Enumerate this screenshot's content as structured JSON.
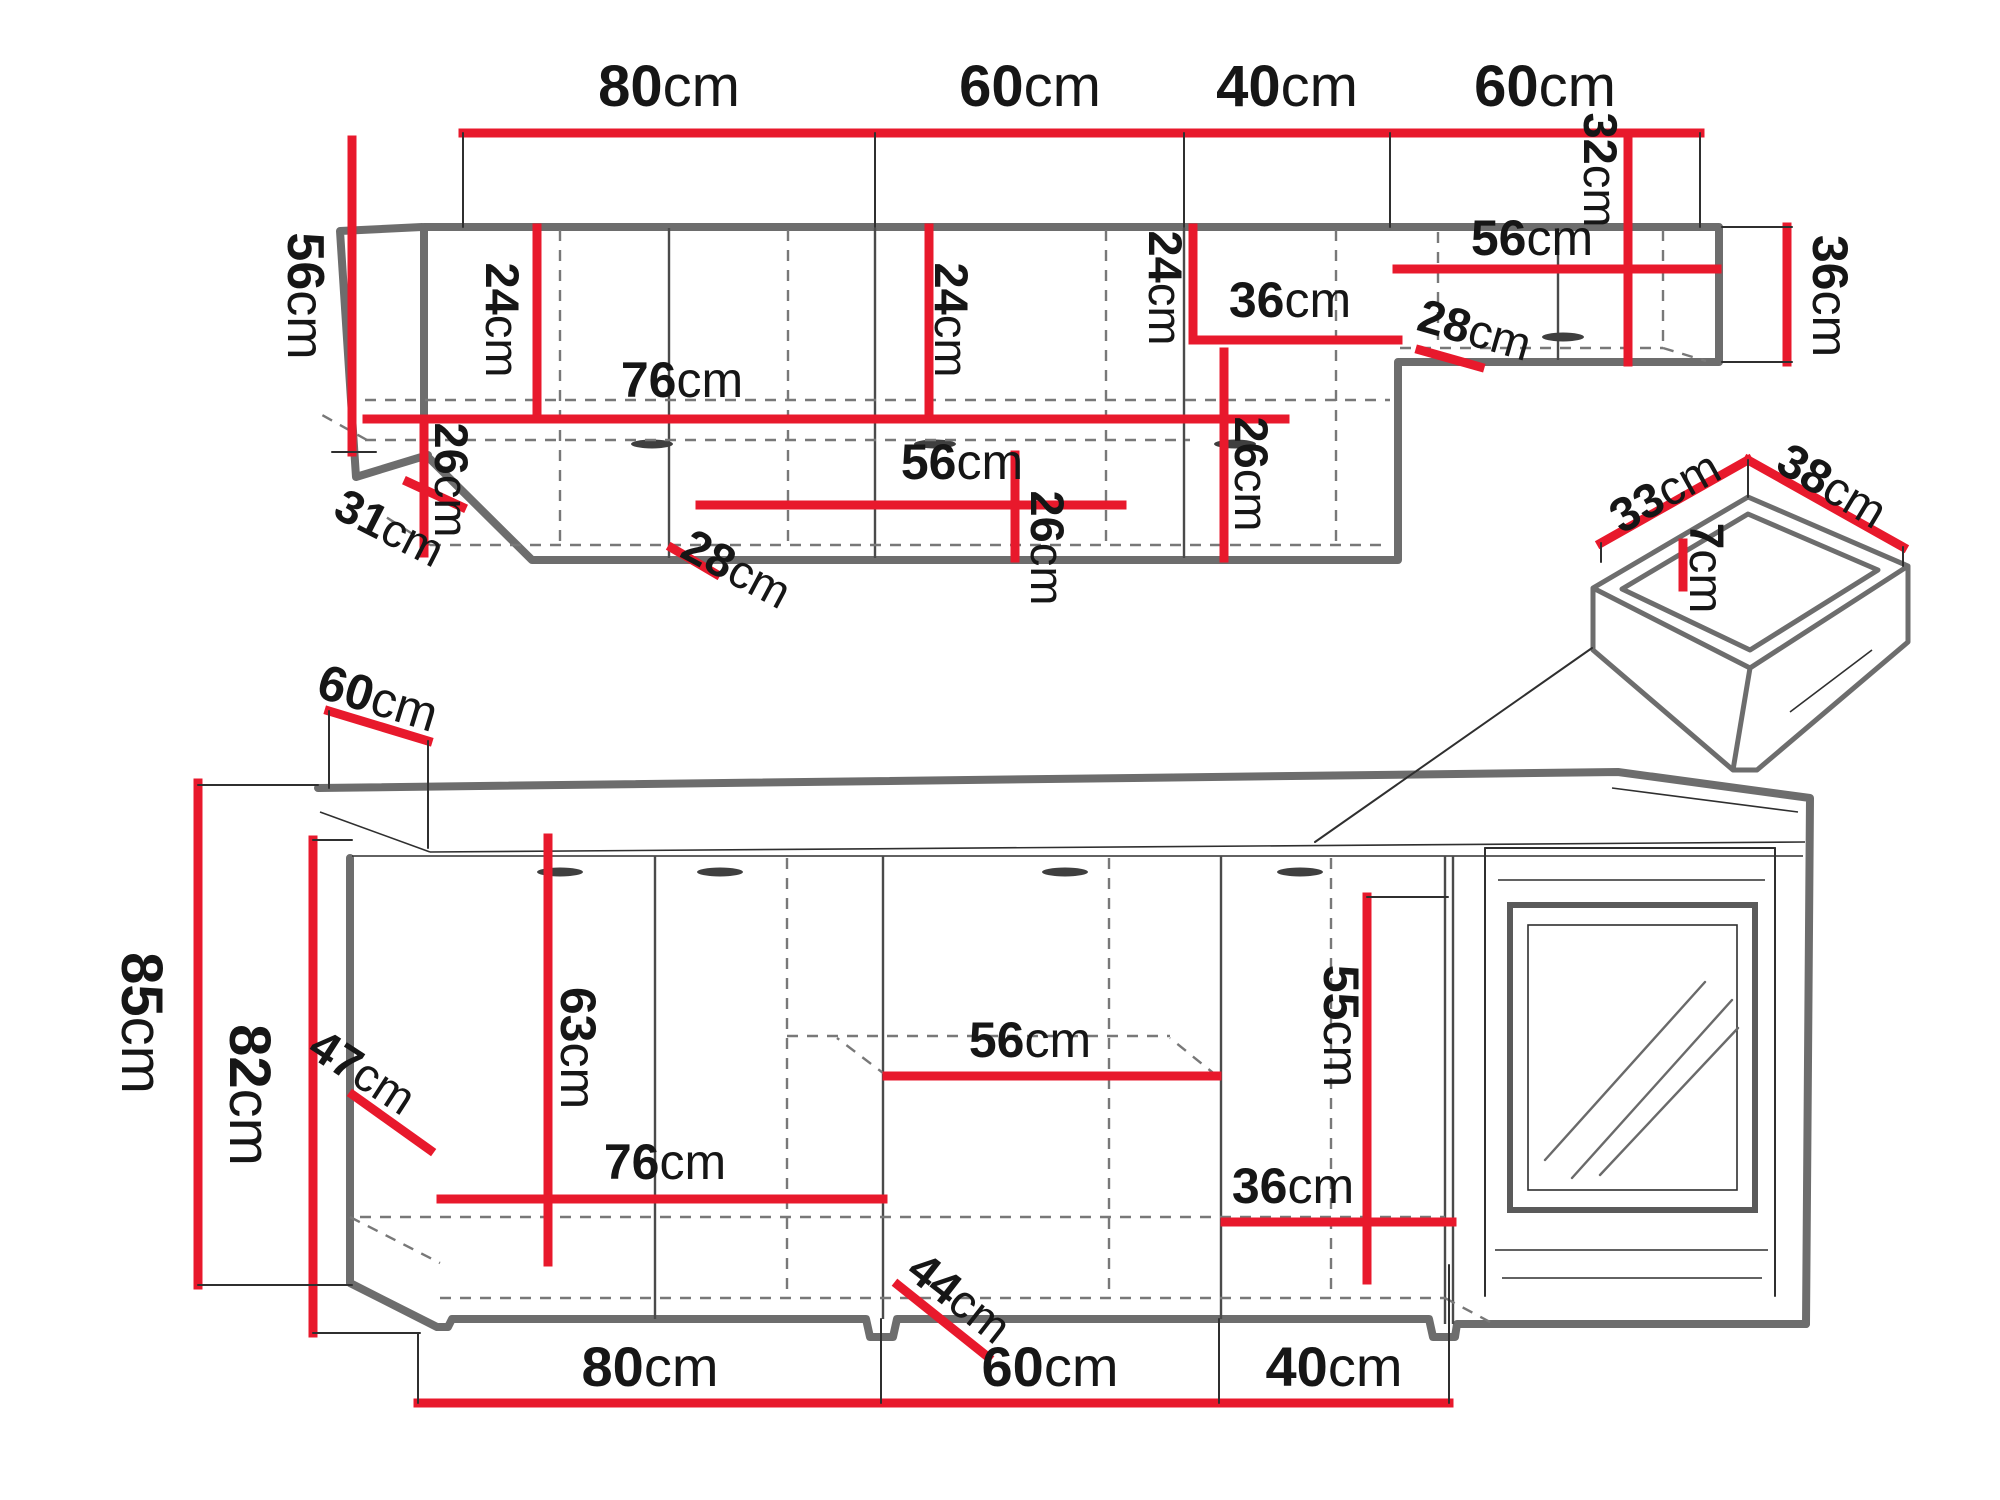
{
  "title": "Kitchen cabinet set dimension diagram",
  "units": "cm",
  "colors": {
    "dimension_red": "#e8192c",
    "outline_gray": "#6d6d6d",
    "thin_black": "#2f2f2f",
    "dashed_gray": "#787878",
    "text_black": "#161616",
    "background": "#ffffff"
  },
  "sections": {
    "wall_cabinets": {
      "top_widths": [
        "80cm",
        "60cm",
        "40cm",
        "60cm"
      ],
      "height_left": "56cm",
      "height_right": "36cm",
      "corner_front_width": "31cm",
      "interior_dims": [
        "24cm",
        "76cm",
        "26cm",
        "28cm",
        "24cm",
        "56cm",
        "26cm",
        "24cm",
        "36cm",
        "26cm",
        "28cm",
        "56cm",
        "32cm"
      ]
    },
    "base_cabinets": {
      "counter_depth": "60cm",
      "total_height": "85cm",
      "carcass_height": "82cm",
      "interior_dims": [
        "47cm",
        "63cm",
        "76cm",
        "56cm",
        "44cm",
        "36cm",
        "55cm"
      ],
      "bottom_widths": [
        "80cm",
        "60cm",
        "40cm"
      ]
    },
    "drawer_detail": {
      "width": "33cm",
      "depth": "38cm",
      "inner_height": "7cm"
    }
  },
  "labels": [
    {
      "name": "top-width-80cm",
      "value": "80",
      "unit": "cm",
      "x": 669,
      "y": 86,
      "rot": 0,
      "size": 58
    },
    {
      "name": "top-width-60cm-a",
      "value": "60",
      "unit": "cm",
      "x": 1030,
      "y": 86,
      "rot": 0,
      "size": 58
    },
    {
      "name": "top-width-40cm",
      "value": "40",
      "unit": "cm",
      "x": 1287,
      "y": 86,
      "rot": 0,
      "size": 58
    },
    {
      "name": "top-width-60cm-b",
      "value": "60",
      "unit": "cm",
      "x": 1545,
      "y": 86,
      "rot": 0,
      "size": 58
    },
    {
      "name": "wall-height-56cm-left",
      "value": "56",
      "unit": "cm",
      "x": 305,
      "y": 296,
      "rot": 90,
      "size": 52
    },
    {
      "name": "wall-24cm-a",
      "value": "24",
      "unit": "cm",
      "x": 503,
      "y": 320,
      "rot": 90,
      "size": 47
    },
    {
      "name": "wall-76cm",
      "value": "76",
      "unit": "cm",
      "x": 682,
      "y": 380,
      "rot": 0,
      "size": 50
    },
    {
      "name": "wall-26cm-a",
      "value": "26",
      "unit": "cm",
      "x": 452,
      "y": 480,
      "rot": 90,
      "size": 47
    },
    {
      "name": "wall-28cm-a",
      "value": "28",
      "unit": "cm",
      "x": 737,
      "y": 568,
      "rot": 28,
      "size": 47
    },
    {
      "name": "wall-24cm-b",
      "value": "24",
      "unit": "cm",
      "x": 952,
      "y": 320,
      "rot": 90,
      "size": 47
    },
    {
      "name": "wall-56cm-mid",
      "value": "56",
      "unit": "cm",
      "x": 962,
      "y": 462,
      "rot": 0,
      "size": 50
    },
    {
      "name": "wall-26cm-b",
      "value": "26",
      "unit": "cm",
      "x": 1048,
      "y": 548,
      "rot": 90,
      "size": 47
    },
    {
      "name": "wall-24cm-c",
      "value": "24",
      "unit": "cm",
      "x": 1166,
      "y": 288,
      "rot": 90,
      "size": 47
    },
    {
      "name": "wall-36cm-mid",
      "value": "36",
      "unit": "cm",
      "x": 1290,
      "y": 300,
      "rot": 0,
      "size": 50
    },
    {
      "name": "wall-26cm-c",
      "value": "26",
      "unit": "cm",
      "x": 1252,
      "y": 474,
      "rot": 90,
      "size": 47
    },
    {
      "name": "wall-28cm-b",
      "value": "28",
      "unit": "cm",
      "x": 1475,
      "y": 329,
      "rot": 16,
      "size": 47
    },
    {
      "name": "wall-56cm-right",
      "value": "56",
      "unit": "cm",
      "x": 1532,
      "y": 238,
      "rot": 0,
      "size": 50
    },
    {
      "name": "wall-32cm",
      "value": "32",
      "unit": "cm",
      "x": 1601,
      "y": 170,
      "rot": 90,
      "size": 47
    },
    {
      "name": "wall-36cm-right",
      "value": "36",
      "unit": "cm",
      "x": 1830,
      "y": 296,
      "rot": 90,
      "size": 50
    },
    {
      "name": "wall-31cm",
      "value": "31",
      "unit": "cm",
      "x": 390,
      "y": 527,
      "rot": 27,
      "size": 47
    },
    {
      "name": "drawer-33cm",
      "value": "33",
      "unit": "cm",
      "x": 1665,
      "y": 492,
      "rot": -29,
      "size": 48
    },
    {
      "name": "drawer-38cm",
      "value": "38",
      "unit": "cm",
      "x": 1832,
      "y": 486,
      "rot": 31,
      "size": 48
    },
    {
      "name": "drawer-7cm",
      "value": "7",
      "unit": "cm",
      "x": 1706,
      "y": 568,
      "rot": 90,
      "size": 48
    },
    {
      "name": "base-60cm-top",
      "value": "60",
      "unit": "cm",
      "x": 378,
      "y": 698,
      "rot": 17,
      "size": 50
    },
    {
      "name": "base-85cm",
      "value": "85",
      "unit": "cm",
      "x": 142,
      "y": 1023,
      "rot": 90,
      "size": 58
    },
    {
      "name": "base-82cm",
      "value": "82",
      "unit": "cm",
      "x": 250,
      "y": 1095,
      "rot": 90,
      "size": 58
    },
    {
      "name": "base-47cm",
      "value": "47",
      "unit": "cm",
      "x": 363,
      "y": 1071,
      "rot": 33,
      "size": 47
    },
    {
      "name": "base-63cm",
      "value": "63",
      "unit": "cm",
      "x": 578,
      "y": 1048,
      "rot": 90,
      "size": 50
    },
    {
      "name": "base-76cm",
      "value": "76",
      "unit": "cm",
      "x": 665,
      "y": 1162,
      "rot": 0,
      "size": 50
    },
    {
      "name": "base-56cm",
      "value": "56",
      "unit": "cm",
      "x": 1030,
      "y": 1040,
      "rot": 0,
      "size": 50
    },
    {
      "name": "base-44cm",
      "value": "44",
      "unit": "cm",
      "x": 960,
      "y": 1297,
      "rot": 38,
      "size": 47
    },
    {
      "name": "base-36cm",
      "value": "36",
      "unit": "cm",
      "x": 1293,
      "y": 1186,
      "rot": 0,
      "size": 50
    },
    {
      "name": "base-55cm",
      "value": "55",
      "unit": "cm",
      "x": 1341,
      "y": 1026,
      "rot": 90,
      "size": 50
    },
    {
      "name": "base-width-80cm",
      "value": "80",
      "unit": "cm",
      "x": 650,
      "y": 1366,
      "rot": 0,
      "size": 56
    },
    {
      "name": "base-width-60cm",
      "value": "60",
      "unit": "cm",
      "x": 1050,
      "y": 1366,
      "rot": 0,
      "size": 56
    },
    {
      "name": "base-width-40cm",
      "value": "40",
      "unit": "cm",
      "x": 1334,
      "y": 1366,
      "rot": 0,
      "size": 56
    }
  ]
}
